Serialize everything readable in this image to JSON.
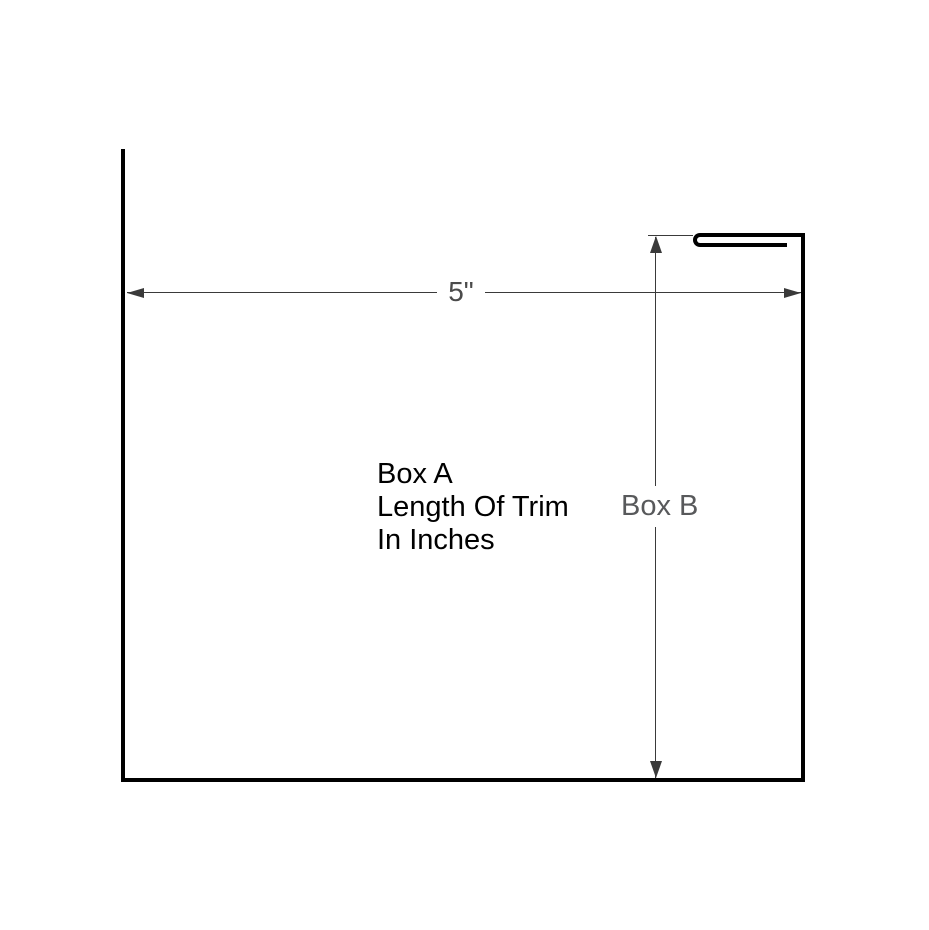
{
  "diagram": {
    "title": "trim-profile-dimension-drawing",
    "horizontal_dimension": {
      "label": "5\""
    },
    "vertical_dimension": {
      "label": "Box B"
    },
    "annotation": {
      "line1": "Box A",
      "line2": "Length Of Trim",
      "line3": "In Inches"
    },
    "colors": {
      "background": "#ffffff",
      "profile_stroke": "#000000",
      "dimension_stroke": "#3a3a3a",
      "dimension_label": "#4b4b4b",
      "box_b_label": "#58595b",
      "annotation_text": "#000000"
    }
  }
}
